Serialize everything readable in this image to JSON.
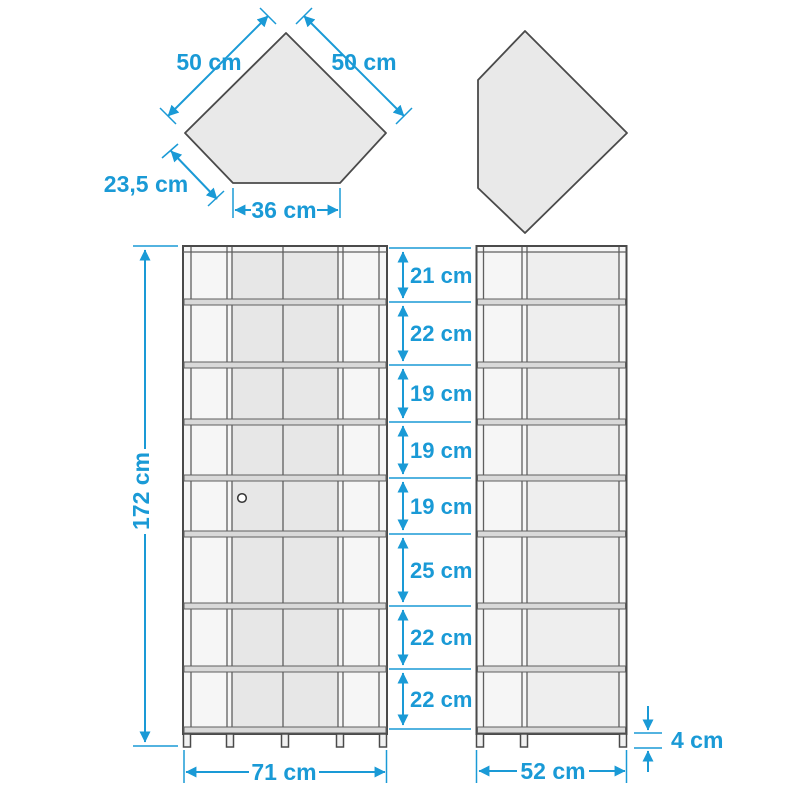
{
  "colors": {
    "dimension_blue": "#1a9ad6",
    "outline_gray": "#4a4a4a",
    "panel_fill": "#e9e9e9"
  },
  "top_view": {
    "left_shape": {
      "left_edge": "50 cm",
      "right_edge": "50 cm",
      "back_left_edge": "23,5 cm",
      "front_edge": "36 cm"
    }
  },
  "front_view": {
    "total_height": "172 cm",
    "total_width": "71 cm",
    "compartment_heights": [
      "21 cm",
      "22 cm",
      "19 cm",
      "19 cm",
      "19 cm",
      "25 cm",
      "22 cm",
      "22 cm"
    ]
  },
  "side_view": {
    "total_depth": "52 cm",
    "leg_height": "4 cm"
  }
}
